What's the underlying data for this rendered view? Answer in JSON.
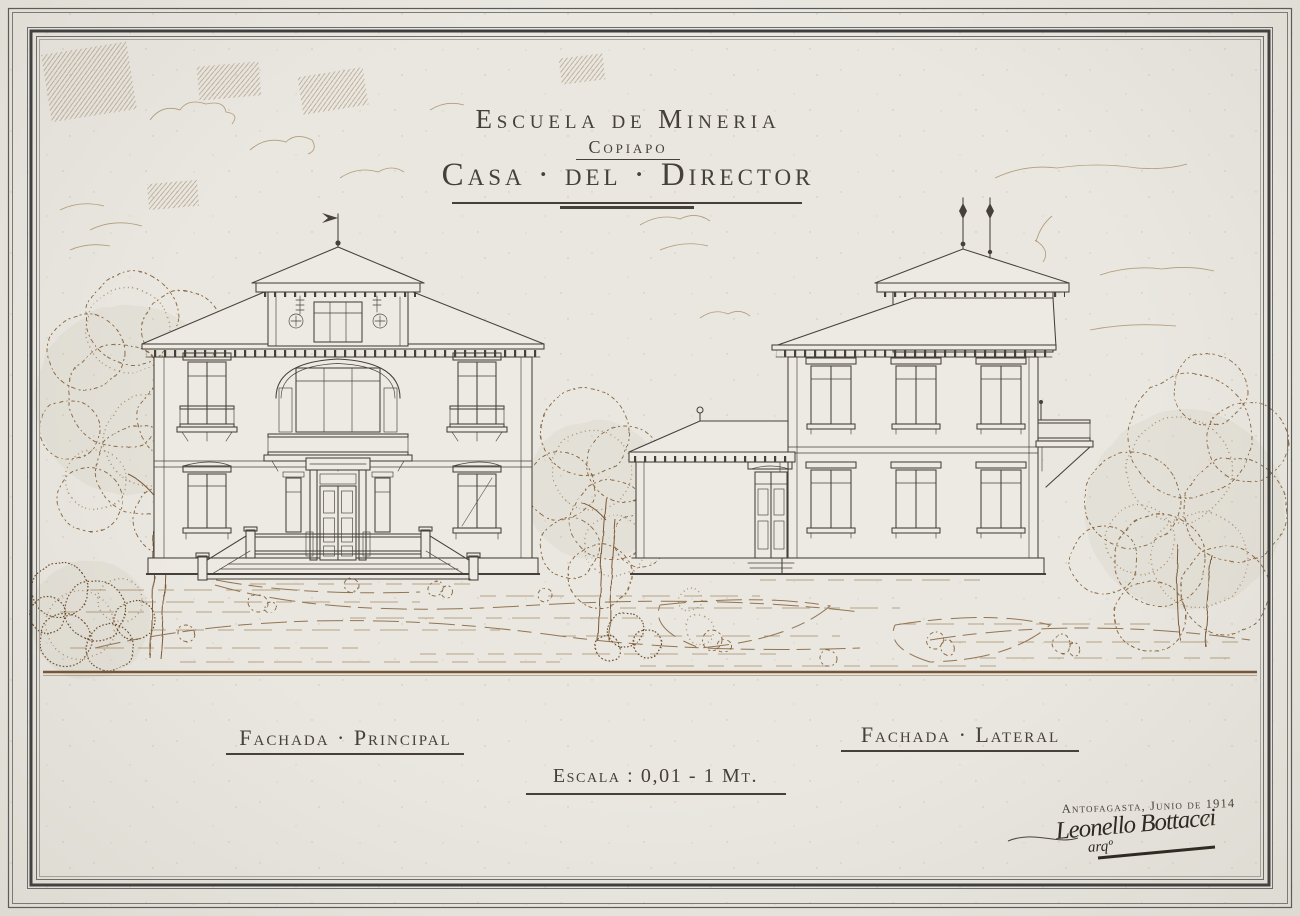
{
  "title_block": {
    "line1": "Escuela de Mineria",
    "line2": "Copiapo",
    "line3": "Casa · del · Director"
  },
  "labels": {
    "left_facade": "Fachada · Principal",
    "right_facade": "Fachada · Lateral",
    "scale": "Escala : 0,01 - 1 Mt."
  },
  "signature_block": {
    "place_date": "Antofagasta, Junio de 1914",
    "name": "Leonello Bottacci",
    "title": "arqº"
  },
  "colors": {
    "paper": "#e9e7e0",
    "ink": "#46403a",
    "sepia": "#8a6843",
    "groundline": "#74563a",
    "frame": "#3e3e3e",
    "signature": "#2b261f"
  }
}
